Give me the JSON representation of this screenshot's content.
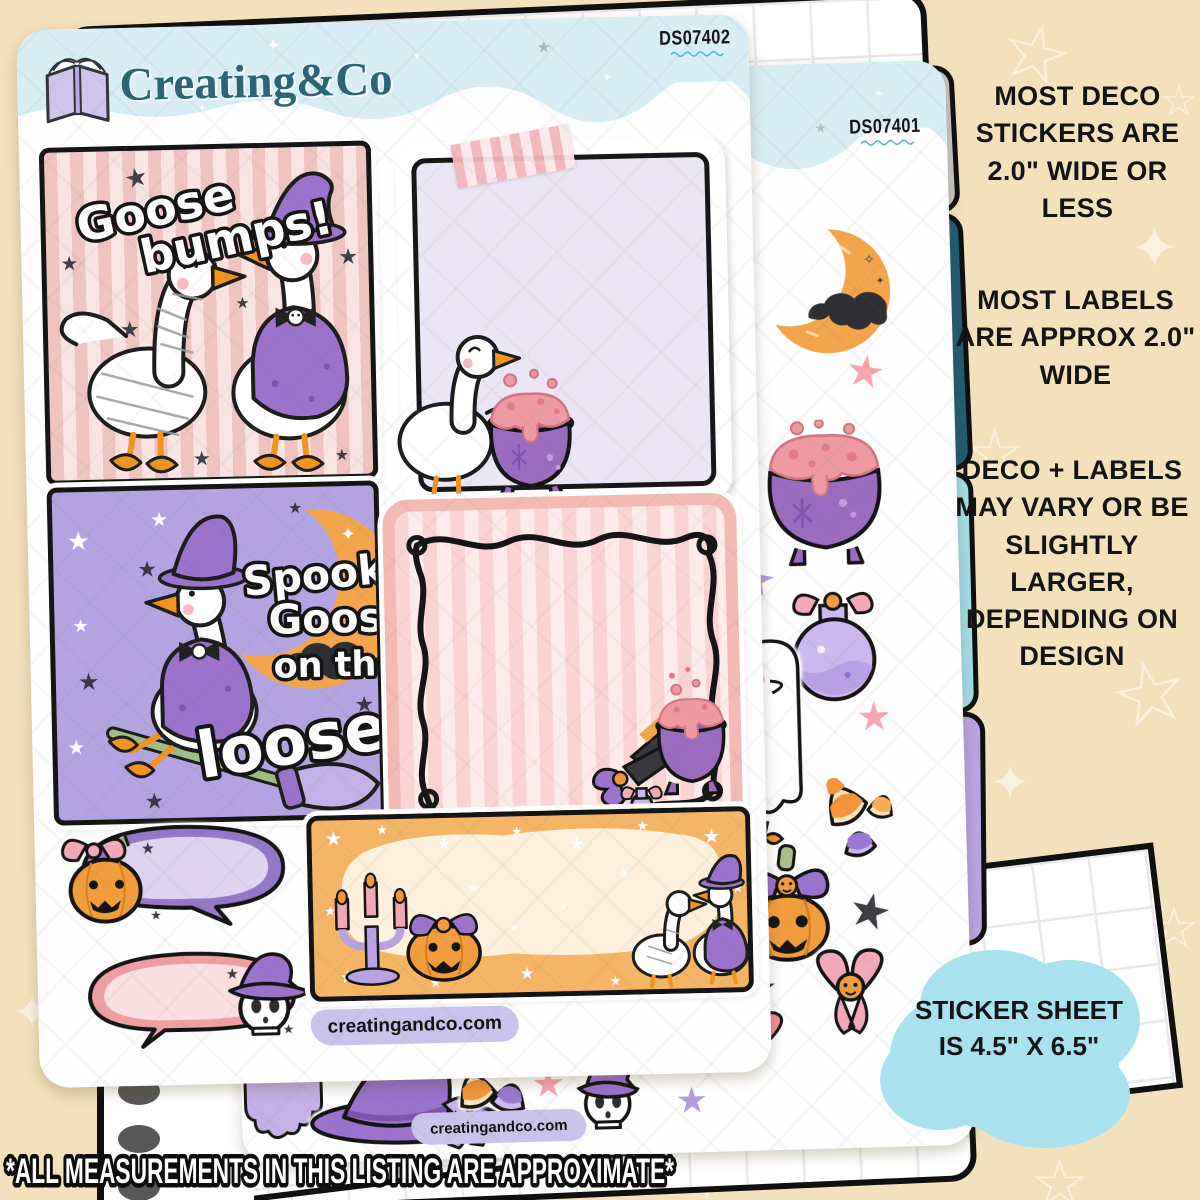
{
  "front_sheet": {
    "code": "DS07402",
    "brand": "Creating&Co",
    "website": "creatingandco.com",
    "goose_bumps_line1": "Goose",
    "goose_bumps_line2": "bumps!",
    "spooky_line1": "Spooky",
    "spooky_line2": "Goose",
    "spooky_line3": "on the",
    "spooky_line4": "loose!"
  },
  "back_sheet": {
    "code": "DS07401",
    "website": "creatingandco.com"
  },
  "annotations": {
    "deco_size": "MOST DECO STICKERS ARE 2.0\" WIDE OR LESS",
    "label_size": "MOST LABELS ARE APPROX 2.0\" WIDE",
    "variance": "DECO + LABELS MAY VARY OR BE SLIGHTLY LARGER, DEPENDING ON DESIGN",
    "sheet_size": "STICKER SHEET IS 4.5\" X 6.5\"",
    "disclaimer": "*ALL MEASUREMENTS IN THIS LISTING ARE APPROXIMATE*"
  },
  "icons": {
    "logo": "open-book-icon",
    "deco_sticker_names": [
      "purple-star",
      "crescent-moon-with-bat",
      "pink-star",
      "black-star",
      "bubbling-cauldron",
      "potion-bottle-with-bow",
      "ghost-goose",
      "candy-corn",
      "jack-o-lantern-with-bow",
      "pink-bow-with-pumpkin",
      "skull-with-witch-hat",
      "witch-hat-with-bow",
      "drippy-slime",
      "spiral-binding",
      "divider-tabs"
    ]
  },
  "colors": {
    "background": "#f3e1bd",
    "header_blue": "#d9edf5",
    "brand_teal": "#2c6573",
    "sticker_pink": "#f2c9c6",
    "sticker_purple": "#b3a3e0",
    "sticker_orange": "#f5b566",
    "tab_gray": "#c9c9c9",
    "tab_teal": "#205d75",
    "tab_cyan": "#a5dde8",
    "tab_purple": "#b9a5e4",
    "cloud_blue": "#a9e2ee",
    "pill_lavender": "#c9c3ec"
  }
}
